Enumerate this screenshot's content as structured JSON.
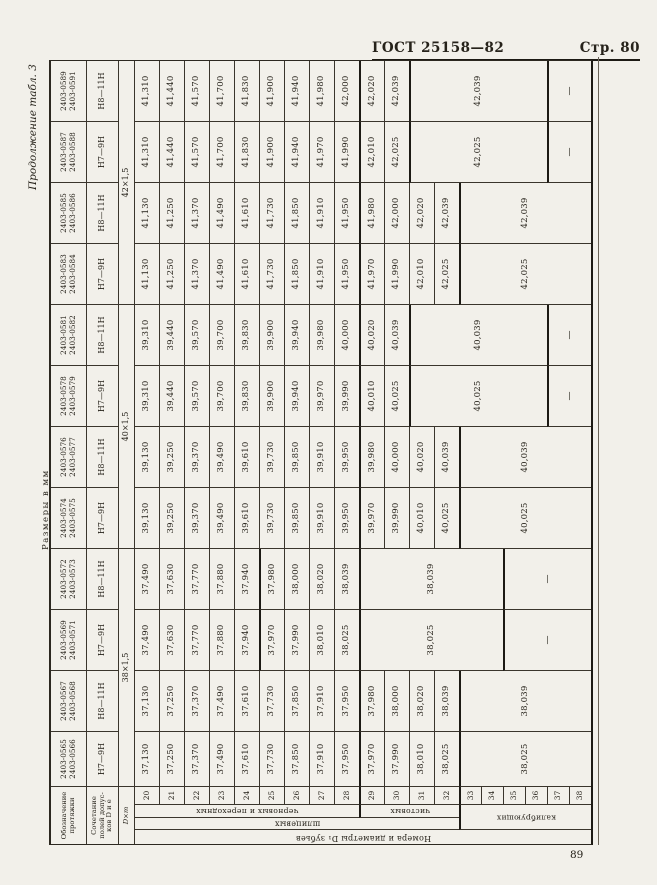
{
  "page": {
    "gost_header": "ГОСТ 25158—82",
    "page_ref": "Стр. 80",
    "continuation": "Продолжение табл. 3",
    "units_note": "Размеры в мм",
    "page_number": "89"
  },
  "table": {
    "corner_labels": {
      "designation": "Обозначение протяжки",
      "tolerance": "Сочетание полей допус­ков D и е",
      "size": "D×m"
    },
    "row_axis": {
      "title": "Номера и диаметры D₁ зубьев",
      "spline": "шлицевых",
      "rough": "черновых и переходных",
      "finish": "чистовых",
      "calibrating": "калибрующих"
    },
    "tooth_numbers": [
      "20",
      "21",
      "22",
      "23",
      "24",
      "25",
      "26",
      "27",
      "28",
      "29",
      "30",
      "31",
      "32",
      "33",
      "34",
      "35",
      "36",
      "37",
      "38"
    ],
    "size_groups": [
      {
        "label": "38×1,5",
        "span": 4
      },
      {
        "label": "40×1,5",
        "span": 4
      },
      {
        "label": "42×1,5",
        "span": 4
      }
    ],
    "columns": [
      {
        "designations": [
          "2403-0565",
          "2403-0566"
        ],
        "tolerance": "Н7—9Н",
        "cells": [
          {
            "v": "37,130"
          },
          {
            "v": "37,250"
          },
          {
            "v": "37,370"
          },
          {
            "v": "37,490"
          },
          {
            "v": "37,610"
          },
          {
            "v": "37,730"
          },
          {
            "v": "37,850"
          },
          {
            "v": "37,910"
          },
          {
            "v": "37,950"
          },
          {
            "v": "37,970"
          },
          {
            "v": "37,990"
          },
          {
            "v": "38,010"
          },
          {
            "v": "38,025"
          },
          {
            "v": "38,025",
            "span": 6
          }
        ],
        "thick_before": [
          29,
          33
        ]
      },
      {
        "designations": [
          "2403-0567",
          "2403-0568"
        ],
        "tolerance": "Н8—11Н",
        "cells": [
          {
            "v": "37,130"
          },
          {
            "v": "37,250"
          },
          {
            "v": "37,370"
          },
          {
            "v": "37,490"
          },
          {
            "v": "37,610"
          },
          {
            "v": "37,730"
          },
          {
            "v": "37,850"
          },
          {
            "v": "37,910"
          },
          {
            "v": "37,950"
          },
          {
            "v": "37,980"
          },
          {
            "v": "38,000"
          },
          {
            "v": "38,020"
          },
          {
            "v": "38,039"
          },
          {
            "v": "38,039",
            "span": 6
          }
        ],
        "thick_before": [
          29,
          33
        ]
      },
      {
        "designations": [
          "2403-0569",
          "2403-0571"
        ],
        "tolerance": "Н7—9Н",
        "cells": [
          {
            "v": "37,490"
          },
          {
            "v": "37,630"
          },
          {
            "v": "37,770"
          },
          {
            "v": "37,880"
          },
          {
            "v": "37,940"
          },
          {
            "v": "37,970"
          },
          {
            "v": "37,990"
          },
          {
            "v": "38,010"
          },
          {
            "v": "38,025"
          },
          {
            "v": "38,025",
            "span": 6
          },
          {
            "v": "—",
            "span": 4
          }
        ],
        "thick_before": [
          25,
          29,
          35
        ]
      },
      {
        "designations": [
          "2403-0572",
          "2403-0573"
        ],
        "tolerance": "Н8—11Н",
        "cells": [
          {
            "v": "37,490"
          },
          {
            "v": "37,630"
          },
          {
            "v": "37,770"
          },
          {
            "v": "37,880"
          },
          {
            "v": "37,940"
          },
          {
            "v": "37,980"
          },
          {
            "v": "38,000"
          },
          {
            "v": "38,020"
          },
          {
            "v": "38,039"
          },
          {
            "v": "38,039",
            "span": 6
          },
          {
            "v": "—",
            "span": 4
          }
        ],
        "thick_before": [
          25,
          29,
          35
        ]
      },
      {
        "designations": [
          "2403-0574",
          "2403-0575"
        ],
        "tolerance": "Н7—9Н",
        "cells": [
          {
            "v": "39,130"
          },
          {
            "v": "39,250"
          },
          {
            "v": "39,370"
          },
          {
            "v": "39,490"
          },
          {
            "v": "39,610"
          },
          {
            "v": "39,730"
          },
          {
            "v": "39,850"
          },
          {
            "v": "39,910"
          },
          {
            "v": "39,950"
          },
          {
            "v": "39,970"
          },
          {
            "v": "39,990"
          },
          {
            "v": "40,010"
          },
          {
            "v": "40,025"
          },
          {
            "v": "40,025",
            "span": 6
          }
        ],
        "thick_before": [
          29,
          33
        ]
      },
      {
        "designations": [
          "2403-0576",
          "2403-0577"
        ],
        "tolerance": "Н8—11Н",
        "cells": [
          {
            "v": "39,130"
          },
          {
            "v": "39,250"
          },
          {
            "v": "39,370"
          },
          {
            "v": "39,490"
          },
          {
            "v": "39,610"
          },
          {
            "v": "39,730"
          },
          {
            "v": "39,850"
          },
          {
            "v": "39,910"
          },
          {
            "v": "39,950"
          },
          {
            "v": "39,980"
          },
          {
            "v": "40,000"
          },
          {
            "v": "40,020"
          },
          {
            "v": "40,039"
          },
          {
            "v": "40,039",
            "span": 6
          }
        ],
        "thick_before": [
          29,
          33
        ]
      },
      {
        "designations": [
          "2403-0578",
          "2403-0579"
        ],
        "tolerance": "Н7—9Н",
        "cells": [
          {
            "v": "39,310"
          },
          {
            "v": "39,440"
          },
          {
            "v": "39,570"
          },
          {
            "v": "39,700"
          },
          {
            "v": "39,830"
          },
          {
            "v": "39,900"
          },
          {
            "v": "39,940"
          },
          {
            "v": "39,970"
          },
          {
            "v": "39,990"
          },
          {
            "v": "40,010"
          },
          {
            "v": "40,025"
          },
          {
            "v": "40,025",
            "span": 6
          },
          {
            "v": "—",
            "span": 2
          }
        ],
        "thick_before": [
          29,
          31,
          37
        ]
      },
      {
        "designations": [
          "2403-0581",
          "2403-0582"
        ],
        "tolerance": "Н8—11Н",
        "cells": [
          {
            "v": "39,310"
          },
          {
            "v": "39,440"
          },
          {
            "v": "39,570"
          },
          {
            "v": "39,700"
          },
          {
            "v": "39,830"
          },
          {
            "v": "39,900"
          },
          {
            "v": "39,940"
          },
          {
            "v": "39,980"
          },
          {
            "v": "40,000"
          },
          {
            "v": "40,020"
          },
          {
            "v": "40,039"
          },
          {
            "v": "40,039",
            "span": 6
          },
          {
            "v": "—",
            "span": 2
          }
        ],
        "thick_before": [
          29,
          31,
          37
        ]
      },
      {
        "designations": [
          "2403-0583",
          "2403-0584"
        ],
        "tolerance": "Н7—9Н",
        "cells": [
          {
            "v": "41,130"
          },
          {
            "v": "41,250"
          },
          {
            "v": "41,370"
          },
          {
            "v": "41,490"
          },
          {
            "v": "41,610"
          },
          {
            "v": "41,730"
          },
          {
            "v": "41,850"
          },
          {
            "v": "41,910"
          },
          {
            "v": "41,950"
          },
          {
            "v": "41,970"
          },
          {
            "v": "41,990"
          },
          {
            "v": "42,010"
          },
          {
            "v": "42,025"
          },
          {
            "v": "42,025",
            "span": 6
          }
        ],
        "thick_before": [
          29,
          33
        ]
      },
      {
        "designations": [
          "2403-0585",
          "2403-0586"
        ],
        "tolerance": "Н8—11Н",
        "cells": [
          {
            "v": "41,130"
          },
          {
            "v": "41,250"
          },
          {
            "v": "41,370"
          },
          {
            "v": "41,490"
          },
          {
            "v": "41,610"
          },
          {
            "v": "41,730"
          },
          {
            "v": "41,850"
          },
          {
            "v": "41,910"
          },
          {
            "v": "41,950"
          },
          {
            "v": "41,980"
          },
          {
            "v": "42,000"
          },
          {
            "v": "42,020"
          },
          {
            "v": "42,039"
          },
          {
            "v": "42,039",
            "span": 6
          }
        ],
        "thick_before": [
          29,
          33
        ]
      },
      {
        "designations": [
          "2403-0587",
          "2403-0588"
        ],
        "tolerance": "Н7—9Н",
        "cells": [
          {
            "v": "41,310"
          },
          {
            "v": "41,440"
          },
          {
            "v": "41,570"
          },
          {
            "v": "41,700"
          },
          {
            "v": "41,830"
          },
          {
            "v": "41,900"
          },
          {
            "v": "41,940"
          },
          {
            "v": "41,970"
          },
          {
            "v": "41,990"
          },
          {
            "v": "42,010"
          },
          {
            "v": "42,025"
          },
          {
            "v": "42,025",
            "span": 6
          },
          {
            "v": "—",
            "span": 2
          }
        ],
        "thick_before": [
          29,
          31,
          37
        ]
      },
      {
        "designations": [
          "2403-0589",
          "2403-0591"
        ],
        "tolerance": "Н8—11Н",
        "cells": [
          {
            "v": "41,310"
          },
          {
            "v": "41,440"
          },
          {
            "v": "41,570"
          },
          {
            "v": "41,700"
          },
          {
            "v": "41,830"
          },
          {
            "v": "41,900"
          },
          {
            "v": "41,940"
          },
          {
            "v": "41,980"
          },
          {
            "v": "42,000"
          },
          {
            "v": "42,020"
          },
          {
            "v": "42,039"
          },
          {
            "v": "42,039",
            "span": 6
          },
          {
            "v": "—",
            "span": 2
          }
        ],
        "thick_before": [
          29,
          31,
          37
        ]
      }
    ]
  }
}
